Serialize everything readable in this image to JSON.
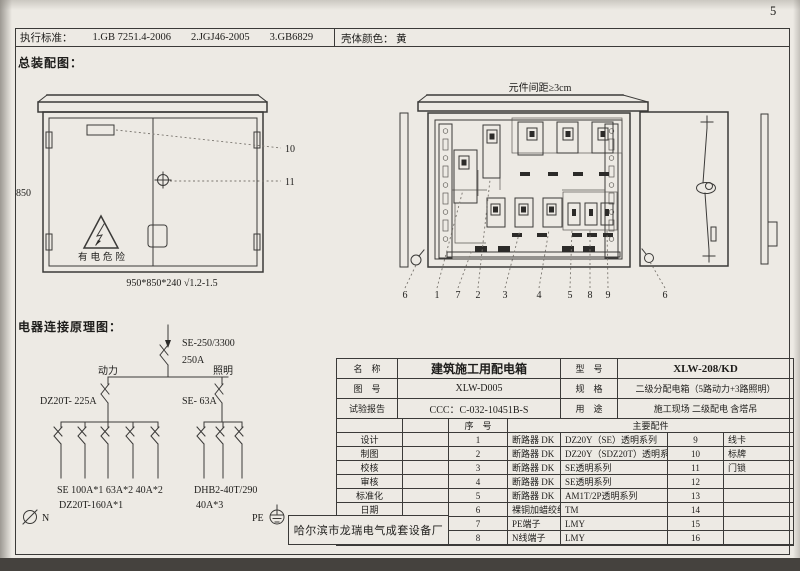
{
  "page": {
    "number": "5"
  },
  "header": {
    "standards_label": "执行标准：",
    "standards": [
      "1.GB 7251.4-2006",
      "2.JGJ46-2005",
      "3.GB6829"
    ],
    "shell_color_label": "壳体颜色：",
    "shell_color_value": "黄"
  },
  "assembly": {
    "title": "总装配图：",
    "front_view": {
      "height_dim": "850",
      "warning_text": "有电危险",
      "size_note": "950*850*240 √1.2-1.5",
      "callout_10": "10",
      "callout_11": "11"
    },
    "internal_view": {
      "spacing_note": "元件间距≥3cm",
      "callouts": [
        "6",
        "1",
        "7",
        "2",
        "3",
        "4",
        "5",
        "8",
        "9",
        "6"
      ]
    }
  },
  "schematic": {
    "title": "电器连接原理图：",
    "main_breaker": "SE-250/3300",
    "main_rating": "250A",
    "power_label": "动力",
    "lighting_label": "照明",
    "power_breaker": "DZ20T- 225A",
    "lighting_breaker": "SE- 63A",
    "power_circuits": "SE 100A*1   63A*2   40A*2",
    "power_circuits2": "DZ20T-160A*1",
    "lighting_circuits": "DHB2-40T/290",
    "lighting_circuits2": "40A*3",
    "neutral_label": "N",
    "pe_label": "PE"
  },
  "title_block": {
    "name_label": "名　称",
    "name_value": "建筑施工用配电箱",
    "model_label": "型　号",
    "model_value": "XLW-208/KD",
    "drawing_label": "图　号",
    "drawing_value": "XLW-D005",
    "spec_label": "规　格",
    "spec_value": "二级分配电箱（5路动力+3路照明）",
    "report_label": "试验报告",
    "report_value": "CCC：C-032-10451B-S",
    "usage_label": "用　途",
    "usage_value": "施工现场 二级配电 含塔吊",
    "serial_header": "序　号",
    "parts_header": "主要配件",
    "roles": [
      "设计",
      "制图",
      "校核",
      "审核",
      "标准化",
      "日期"
    ],
    "company": "哈尔滨市龙瑞电气成套设备厂",
    "rows": [
      {
        "no": "1",
        "part": "断路器 DK",
        "model": "DZ20Y（SE）透明系列",
        "no2": "9",
        "part2": "线卡"
      },
      {
        "no": "2",
        "part": "断路器 DK",
        "model": "DZ20Y（SDZ20T）透明系列",
        "no2": "10",
        "part2": "标牌"
      },
      {
        "no": "3",
        "part": "断路器 DK",
        "model": "SE透明系列",
        "no2": "11",
        "part2": "门锁"
      },
      {
        "no": "4",
        "part": "断路器 DK",
        "model": "SE透明系列",
        "no2": "12",
        "part2": ""
      },
      {
        "no": "5",
        "part": "断路器 DK",
        "model": "AM1T/2P透明系列",
        "no2": "13",
        "part2": ""
      },
      {
        "no": "6",
        "part": "裸铜加蜡绞线",
        "model": "TM",
        "no2": "14",
        "part2": ""
      },
      {
        "no": "7",
        "part": "PE端子",
        "model": "LMY",
        "no2": "15",
        "part2": ""
      },
      {
        "no": "8",
        "part": "N线端子",
        "model": "LMY",
        "no2": "16",
        "part2": ""
      }
    ]
  },
  "colors": {
    "paper": "#edeae4",
    "line": "#3b3a38",
    "text": "#1e1d1b",
    "edge_band": "#45423e"
  }
}
